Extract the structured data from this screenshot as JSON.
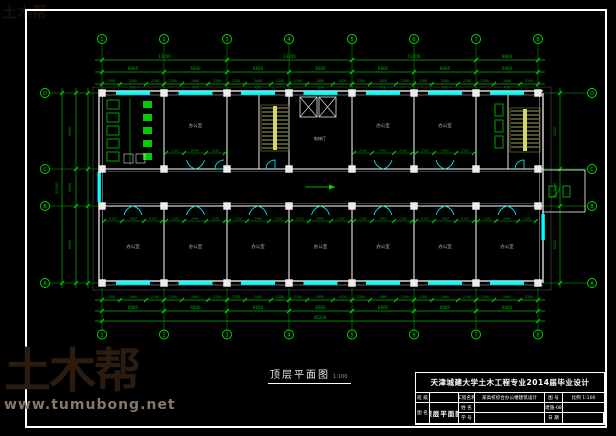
{
  "watermark": {
    "brand": "土木帮",
    "url": "www.tumubong.net"
  },
  "plan": {
    "label": "顶层平面图",
    "scale": "1:100",
    "room_label": "办公室",
    "lobby_label": "电梯厅",
    "window_tag": "C-1",
    "grid_cols": [
      "1",
      "2",
      "3",
      "4",
      "5",
      "6",
      "7",
      "8"
    ],
    "grid_rows": [
      "D",
      "C",
      "B",
      "A"
    ],
    "dims": {
      "bay": "6600",
      "pairs": [
        "13200",
        "13200",
        "13200",
        "6600"
      ],
      "total_w": "46200",
      "sub": [
        "2100",
        "2400",
        "2100"
      ],
      "door": [
        "2100",
        "2400",
        "2100"
      ],
      "left": [
        "8100",
        "3900",
        "8100"
      ],
      "left_total": "20100"
    }
  },
  "title_block": {
    "header": "天津城建大学土木工程专业2014届毕业设计",
    "cells": {
      "r1c1": "班 级",
      "r2c1": "姓 名",
      "r3c1": "学 号",
      "r1c3": "工程名称",
      "r23c3": "图 名",
      "r1c4": "某高校综合办公楼建筑设计",
      "r23c4": "顶层平面图",
      "r1c5": "图 号",
      "r2c5": "建施-08",
      "r3c5": "日 期",
      "r1c6": "比例 1:100",
      "r2c6": "",
      "r3c6": ""
    }
  }
}
